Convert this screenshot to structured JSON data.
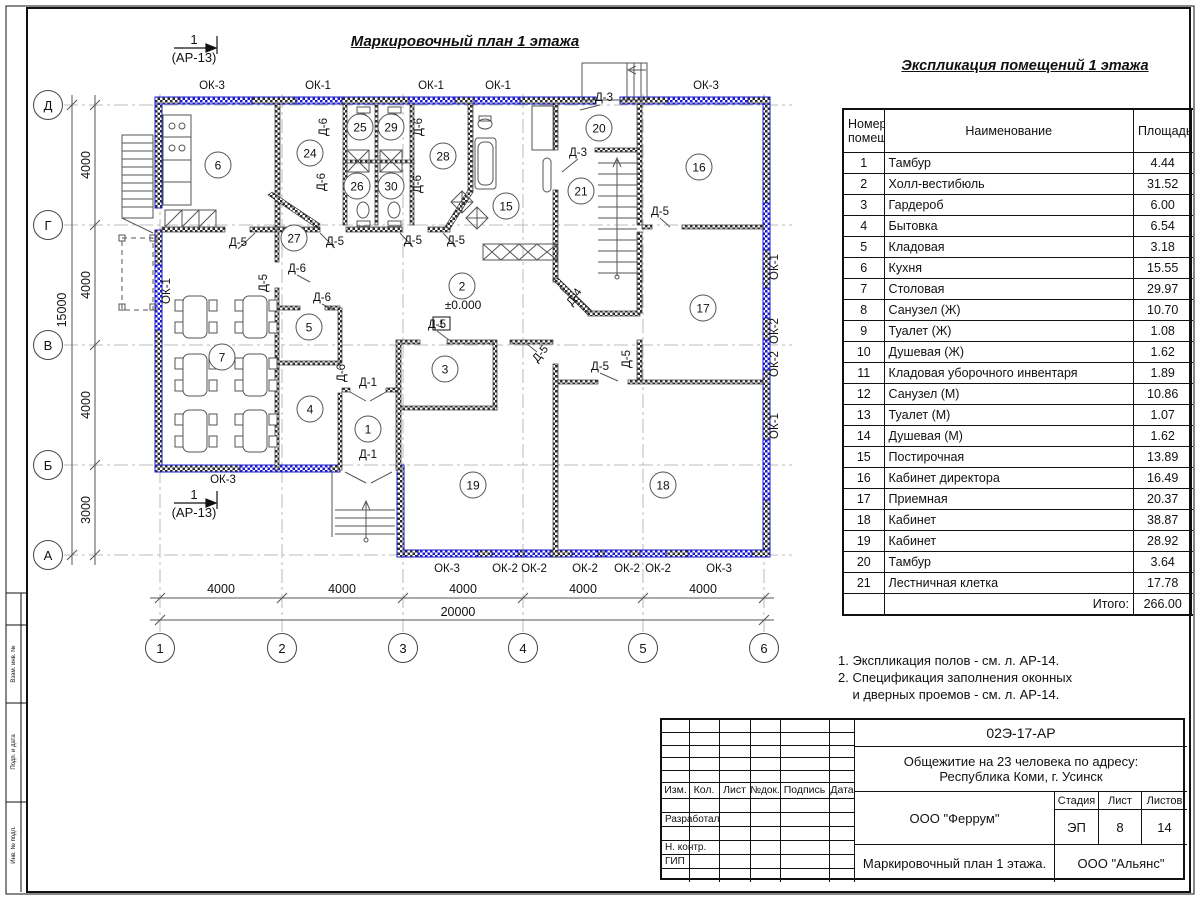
{
  "page": {
    "plan_title": "Маркировочный план 1 этажа",
    "explication_title": "Экспликация помещений 1 этажа"
  },
  "explication": {
    "header": {
      "num1": "Номер",
      "num2": "помещ.",
      "name": "Наименование",
      "area": "Площадь",
      "extra1": "Ка",
      "extra2": "по"
    },
    "rows": [
      {
        "num": "1",
        "name": "Тамбур",
        "area": "4.44"
      },
      {
        "num": "2",
        "name": "Холл-вестибюль",
        "area": "31.52"
      },
      {
        "num": "3",
        "name": "Гардероб",
        "area": "6.00"
      },
      {
        "num": "4",
        "name": "Бытовка",
        "area": "6.54"
      },
      {
        "num": "5",
        "name": "Кладовая",
        "area": "3.18"
      },
      {
        "num": "6",
        "name": "Кухня",
        "area": "15.55"
      },
      {
        "num": "7",
        "name": "Столовая",
        "area": "29.97"
      },
      {
        "num": "8",
        "name": "Санузел (Ж)",
        "area": "10.70"
      },
      {
        "num": "9",
        "name": "Туалет (Ж)",
        "area": "1.08"
      },
      {
        "num": "10",
        "name": "Душевая (Ж)",
        "area": "1.62"
      },
      {
        "num": "11",
        "name": "Кладовая уборочного инвентаря",
        "area": "1.89"
      },
      {
        "num": "12",
        "name": "Санузел (М)",
        "area": "10.86"
      },
      {
        "num": "13",
        "name": "Туалет (М)",
        "area": "1.07"
      },
      {
        "num": "14",
        "name": "Душевая (М)",
        "area": "1.62"
      },
      {
        "num": "15",
        "name": "Постирочная",
        "area": "13.89"
      },
      {
        "num": "16",
        "name": "Кабинет директора",
        "area": "16.49"
      },
      {
        "num": "17",
        "name": "Приемная",
        "area": "20.37"
      },
      {
        "num": "18",
        "name": "Кабинет",
        "area": "38.87"
      },
      {
        "num": "19",
        "name": "Кабинет",
        "area": "28.92"
      },
      {
        "num": "20",
        "name": "Тамбур",
        "area": "3.64"
      },
      {
        "num": "21",
        "name": "Лестничная клетка",
        "area": "17.78"
      }
    ],
    "total_label": "Итого:",
    "total_value": "266.00"
  },
  "notes": {
    "line1": "1. Экспликация полов - см. л. АР-14.",
    "line2": "2. Спецификация заполнения оконных",
    "line3": "    и дверных проемов - см. л. АР-14."
  },
  "title_block": {
    "doc_code": "02Э-17-АР",
    "project_line1": "Общежитие на 23 человека по адресу:",
    "project_line2": "Республика Коми, г. Усинск",
    "col_izm": "Изм.",
    "col_kol": "Кол.",
    "col_list": "Лист",
    "col_ndok": "№док.",
    "col_podpis": "Подпись",
    "col_data": "Дата",
    "row_razrabotal": "Разработал",
    "row_nkontr": "Н. контр.",
    "row_gip": "ГИП",
    "org1": "ООО \"Феррум\"",
    "stage_label": "Стадия",
    "sheet_label": "Лист",
    "sheets_label": "Листов",
    "stage": "ЭП",
    "sheet": "8",
    "sheets": "14",
    "drawing_name": "Маркировочный план 1 этажа.",
    "org2": "ООО \"Альянс\""
  },
  "frame": {
    "stamp1": "Взам. инв. №",
    "stamp2": "Подп. и дата",
    "stamp3": "Инв. № подл."
  },
  "plan": {
    "level_mark": "±0.000",
    "floor_type": "1",
    "section_num": "1",
    "section_ref": "(АР-13)",
    "axes_cols": [
      {
        "l": "1",
        "x": 160
      },
      {
        "l": "2",
        "x": 282
      },
      {
        "l": "3",
        "x": 403
      },
      {
        "l": "4",
        "x": 523
      },
      {
        "l": "5",
        "x": 643
      },
      {
        "l": "6",
        "x": 764
      }
    ],
    "axes_rows": [
      {
        "l": "Д",
        "y": 105
      },
      {
        "l": "Г",
        "y": 225
      },
      {
        "l": "В",
        "y": 345
      },
      {
        "l": "Б",
        "y": 465
      },
      {
        "l": "А",
        "y": 555
      }
    ],
    "dims": [
      {
        "t": "4000",
        "x": 221,
        "y": 593
      },
      {
        "t": "4000",
        "x": 342,
        "y": 593
      },
      {
        "t": "4000",
        "x": 463,
        "y": 593
      },
      {
        "t": "4000",
        "x": 583,
        "y": 593
      },
      {
        "t": "4000",
        "x": 703,
        "y": 593
      },
      {
        "t": "20000",
        "x": 458,
        "y": 616
      },
      {
        "t": "4000",
        "x": 90,
        "y": 165,
        "r": -90
      },
      {
        "t": "4000",
        "x": 90,
        "y": 285,
        "r": -90
      },
      {
        "t": "4000",
        "x": 90,
        "y": 405,
        "r": -90
      },
      {
        "t": "3000",
        "x": 90,
        "y": 510,
        "r": -90
      },
      {
        "t": "15000",
        "x": 66,
        "y": 310,
        "r": -90
      }
    ],
    "rooms": [
      {
        "n": "6",
        "x": 218,
        "y": 165
      },
      {
        "n": "24",
        "x": 310,
        "y": 153
      },
      {
        "n": "25",
        "x": 360,
        "y": 127
      },
      {
        "n": "29",
        "x": 391,
        "y": 127
      },
      {
        "n": "26",
        "x": 357,
        "y": 186
      },
      {
        "n": "30",
        "x": 391,
        "y": 186
      },
      {
        "n": "28",
        "x": 443,
        "y": 156
      },
      {
        "n": "15",
        "x": 506,
        "y": 206
      },
      {
        "n": "20",
        "x": 599,
        "y": 128
      },
      {
        "n": "21",
        "x": 581,
        "y": 191
      },
      {
        "n": "16",
        "x": 699,
        "y": 167
      },
      {
        "n": "27",
        "x": 294,
        "y": 238
      },
      {
        "n": "17",
        "x": 703,
        "y": 308
      },
      {
        "n": "5",
        "x": 309,
        "y": 327
      },
      {
        "n": "7",
        "x": 222,
        "y": 357
      },
      {
        "n": "2",
        "x": 462,
        "y": 286
      },
      {
        "n": "3",
        "x": 445,
        "y": 369
      },
      {
        "n": "4",
        "x": 310,
        "y": 409
      },
      {
        "n": "1",
        "x": 368,
        "y": 429
      },
      {
        "n": "19",
        "x": 473,
        "y": 485
      },
      {
        "n": "18",
        "x": 663,
        "y": 485
      }
    ],
    "labels": [
      {
        "t": "ОК-3",
        "x": 212,
        "y": 89
      },
      {
        "t": "ОК-1",
        "x": 318,
        "y": 89
      },
      {
        "t": "ОК-1",
        "x": 431,
        "y": 89
      },
      {
        "t": "ОК-1",
        "x": 498,
        "y": 89
      },
      {
        "t": "ОК-3",
        "x": 706,
        "y": 89
      },
      {
        "t": "ОК-3",
        "x": 223,
        "y": 483
      },
      {
        "t": "ОК-3",
        "x": 447,
        "y": 572
      },
      {
        "t": "ОК-2",
        "x": 505,
        "y": 572
      },
      {
        "t": "ОК-2",
        "x": 534,
        "y": 572
      },
      {
        "t": "ОК-2",
        "x": 585,
        "y": 572
      },
      {
        "t": "ОК-2",
        "x": 627,
        "y": 572
      },
      {
        "t": "ОК-2",
        "x": 658,
        "y": 572
      },
      {
        "t": "ОК-3",
        "x": 719,
        "y": 572
      },
      {
        "t": "ОК-1",
        "x": 778,
        "y": 267,
        "r": -90
      },
      {
        "t": "ОК-2",
        "x": 778,
        "y": 331,
        "r": -90
      },
      {
        "t": "ОК-2",
        "x": 778,
        "y": 364,
        "r": -90
      },
      {
        "t": "ОК-1",
        "x": 778,
        "y": 426,
        "r": -90
      },
      {
        "t": "ОК-1",
        "x": 170,
        "y": 291,
        "r": -90
      },
      {
        "t": "Д-6",
        "x": 327,
        "y": 127,
        "r": -90
      },
      {
        "t": "Д-6",
        "x": 422,
        "y": 127,
        "r": -90
      },
      {
        "t": "Д-6",
        "x": 325,
        "y": 182,
        "r": -90
      },
      {
        "t": "Д-6",
        "x": 421,
        "y": 184,
        "r": -90
      },
      {
        "t": "Д-3",
        "x": 604,
        "y": 101
      },
      {
        "t": "Д-3",
        "x": 578,
        "y": 156
      },
      {
        "t": "Д-5",
        "x": 660,
        "y": 215
      },
      {
        "t": "Д-5",
        "x": 238,
        "y": 246
      },
      {
        "t": "Д-5",
        "x": 335,
        "y": 245
      },
      {
        "t": "Д-5",
        "x": 413,
        "y": 244
      },
      {
        "t": "Д-5",
        "x": 456,
        "y": 244
      },
      {
        "t": "Д-6",
        "x": 297,
        "y": 272
      },
      {
        "t": "Д-6",
        "x": 322,
        "y": 301
      },
      {
        "t": "Д-5",
        "x": 267,
        "y": 283,
        "r": -90
      },
      {
        "t": "Д-4",
        "x": 577,
        "y": 299,
        "r": -55
      },
      {
        "t": "Д-5",
        "x": 437,
        "y": 328
      },
      {
        "t": "Д-5",
        "x": 543,
        "y": 356,
        "r": -50
      },
      {
        "t": "Д-5",
        "x": 600,
        "y": 370
      },
      {
        "t": "Д-5",
        "x": 630,
        "y": 359,
        "r": -90
      },
      {
        "t": "Д-6",
        "x": 345,
        "y": 373,
        "r": -90
      },
      {
        "t": "Д-1",
        "x": 368,
        "y": 386
      },
      {
        "t": "Д-1",
        "x": 368,
        "y": 458
      }
    ]
  },
  "colors": {
    "wall_blue": "#1b1bcd",
    "wall_dark": "#333333",
    "axis_gray": "#9a9a9a"
  }
}
